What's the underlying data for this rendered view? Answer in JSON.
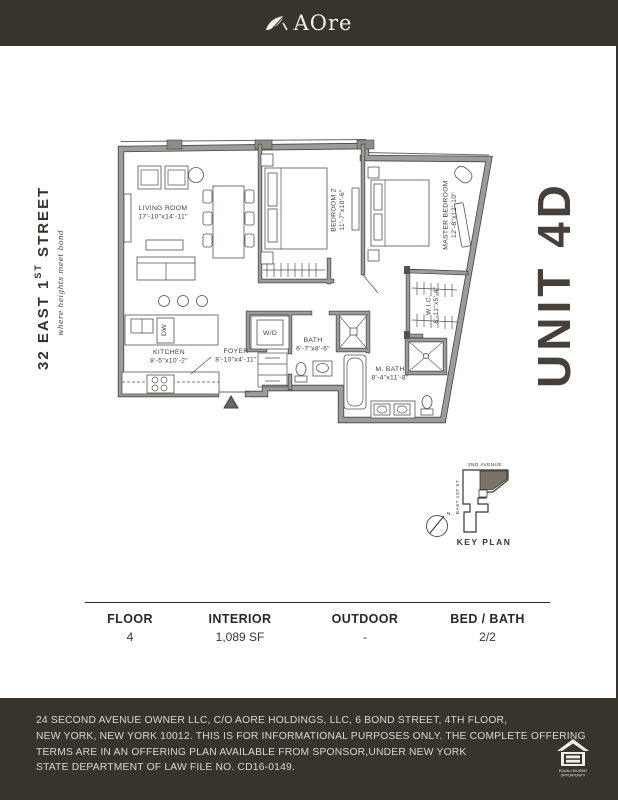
{
  "header": {
    "logo_text": "AOre"
  },
  "left_banner": {
    "address_prefix": "32 EAST 1",
    "address_sup": "ST",
    "address_suffix": " STREET",
    "tagline": "where heights meet bond"
  },
  "unit_label": "UNIT 4D",
  "floorplan": {
    "living_room": {
      "name": "LIVING ROOM",
      "dims": "17'-10\"x14'-11\""
    },
    "bedroom_2": {
      "name": "BEDROOM 2",
      "dims": "11'-7\"x10'-6\""
    },
    "master_bedroom": {
      "name": "MASTER BEDROOM",
      "dims": "12'-8\"x12'-10\""
    },
    "kitchen": {
      "name": "KITCHEN",
      "dims": "8'-5\"x10'-2\""
    },
    "foyer": {
      "name": "FOYER",
      "dims": "8'-10\"x4'-11\""
    },
    "bath": {
      "name": "BATH",
      "dims": "6'-7\"x8'-6\""
    },
    "master_bath": {
      "name": "M. BATH",
      "dims": "8'-4\"x11'-8\""
    },
    "wic": {
      "name": "W.I.C.",
      "dims": "6'-11\"x5'-4\""
    },
    "washer_dryer": "W/D",
    "dishwasher": "DW"
  },
  "key_plan": {
    "title": "KEY PLAN",
    "street_top": "2ND AVENUE",
    "street_left": "EAST 1ST ST",
    "north": "N"
  },
  "stats": {
    "columns": [
      {
        "label": "FLOOR",
        "value": "4"
      },
      {
        "label": "INTERIOR",
        "value": "1,089 SF"
      },
      {
        "label": "OUTDOOR",
        "value": "-"
      },
      {
        "label": "BED / BATH",
        "value": "2/2"
      }
    ]
  },
  "footer": {
    "lines": [
      "24 SECOND AVENUE OWNER LLC, C/O AORE HOLDINGS, LLC, 6 BOND STREET, 4TH FLOOR,",
      "NEW YORK, NEW YORK 10012. THIS IS FOR INFORMATIONAL PURPOSES ONLY. THE COMPLETE OFFERING",
      "TERMS ARE IN AN OFFERING PLAN AVAILABLE FROM SPONSOR,UNDER NEW YORK",
      "STATE DEPARTMENT OF LAW FILE NO. CD16-0149."
    ],
    "equal_housing_line1": "EQUAL HOUSING",
    "equal_housing_line2": "OPPORTUNITY"
  },
  "colors": {
    "brand_dark": "#39332e",
    "cream": "#f3efe6",
    "wall_gray": "#9c9c9c",
    "wall_edge": "#45413c",
    "unit_fill": "#7b7369"
  }
}
